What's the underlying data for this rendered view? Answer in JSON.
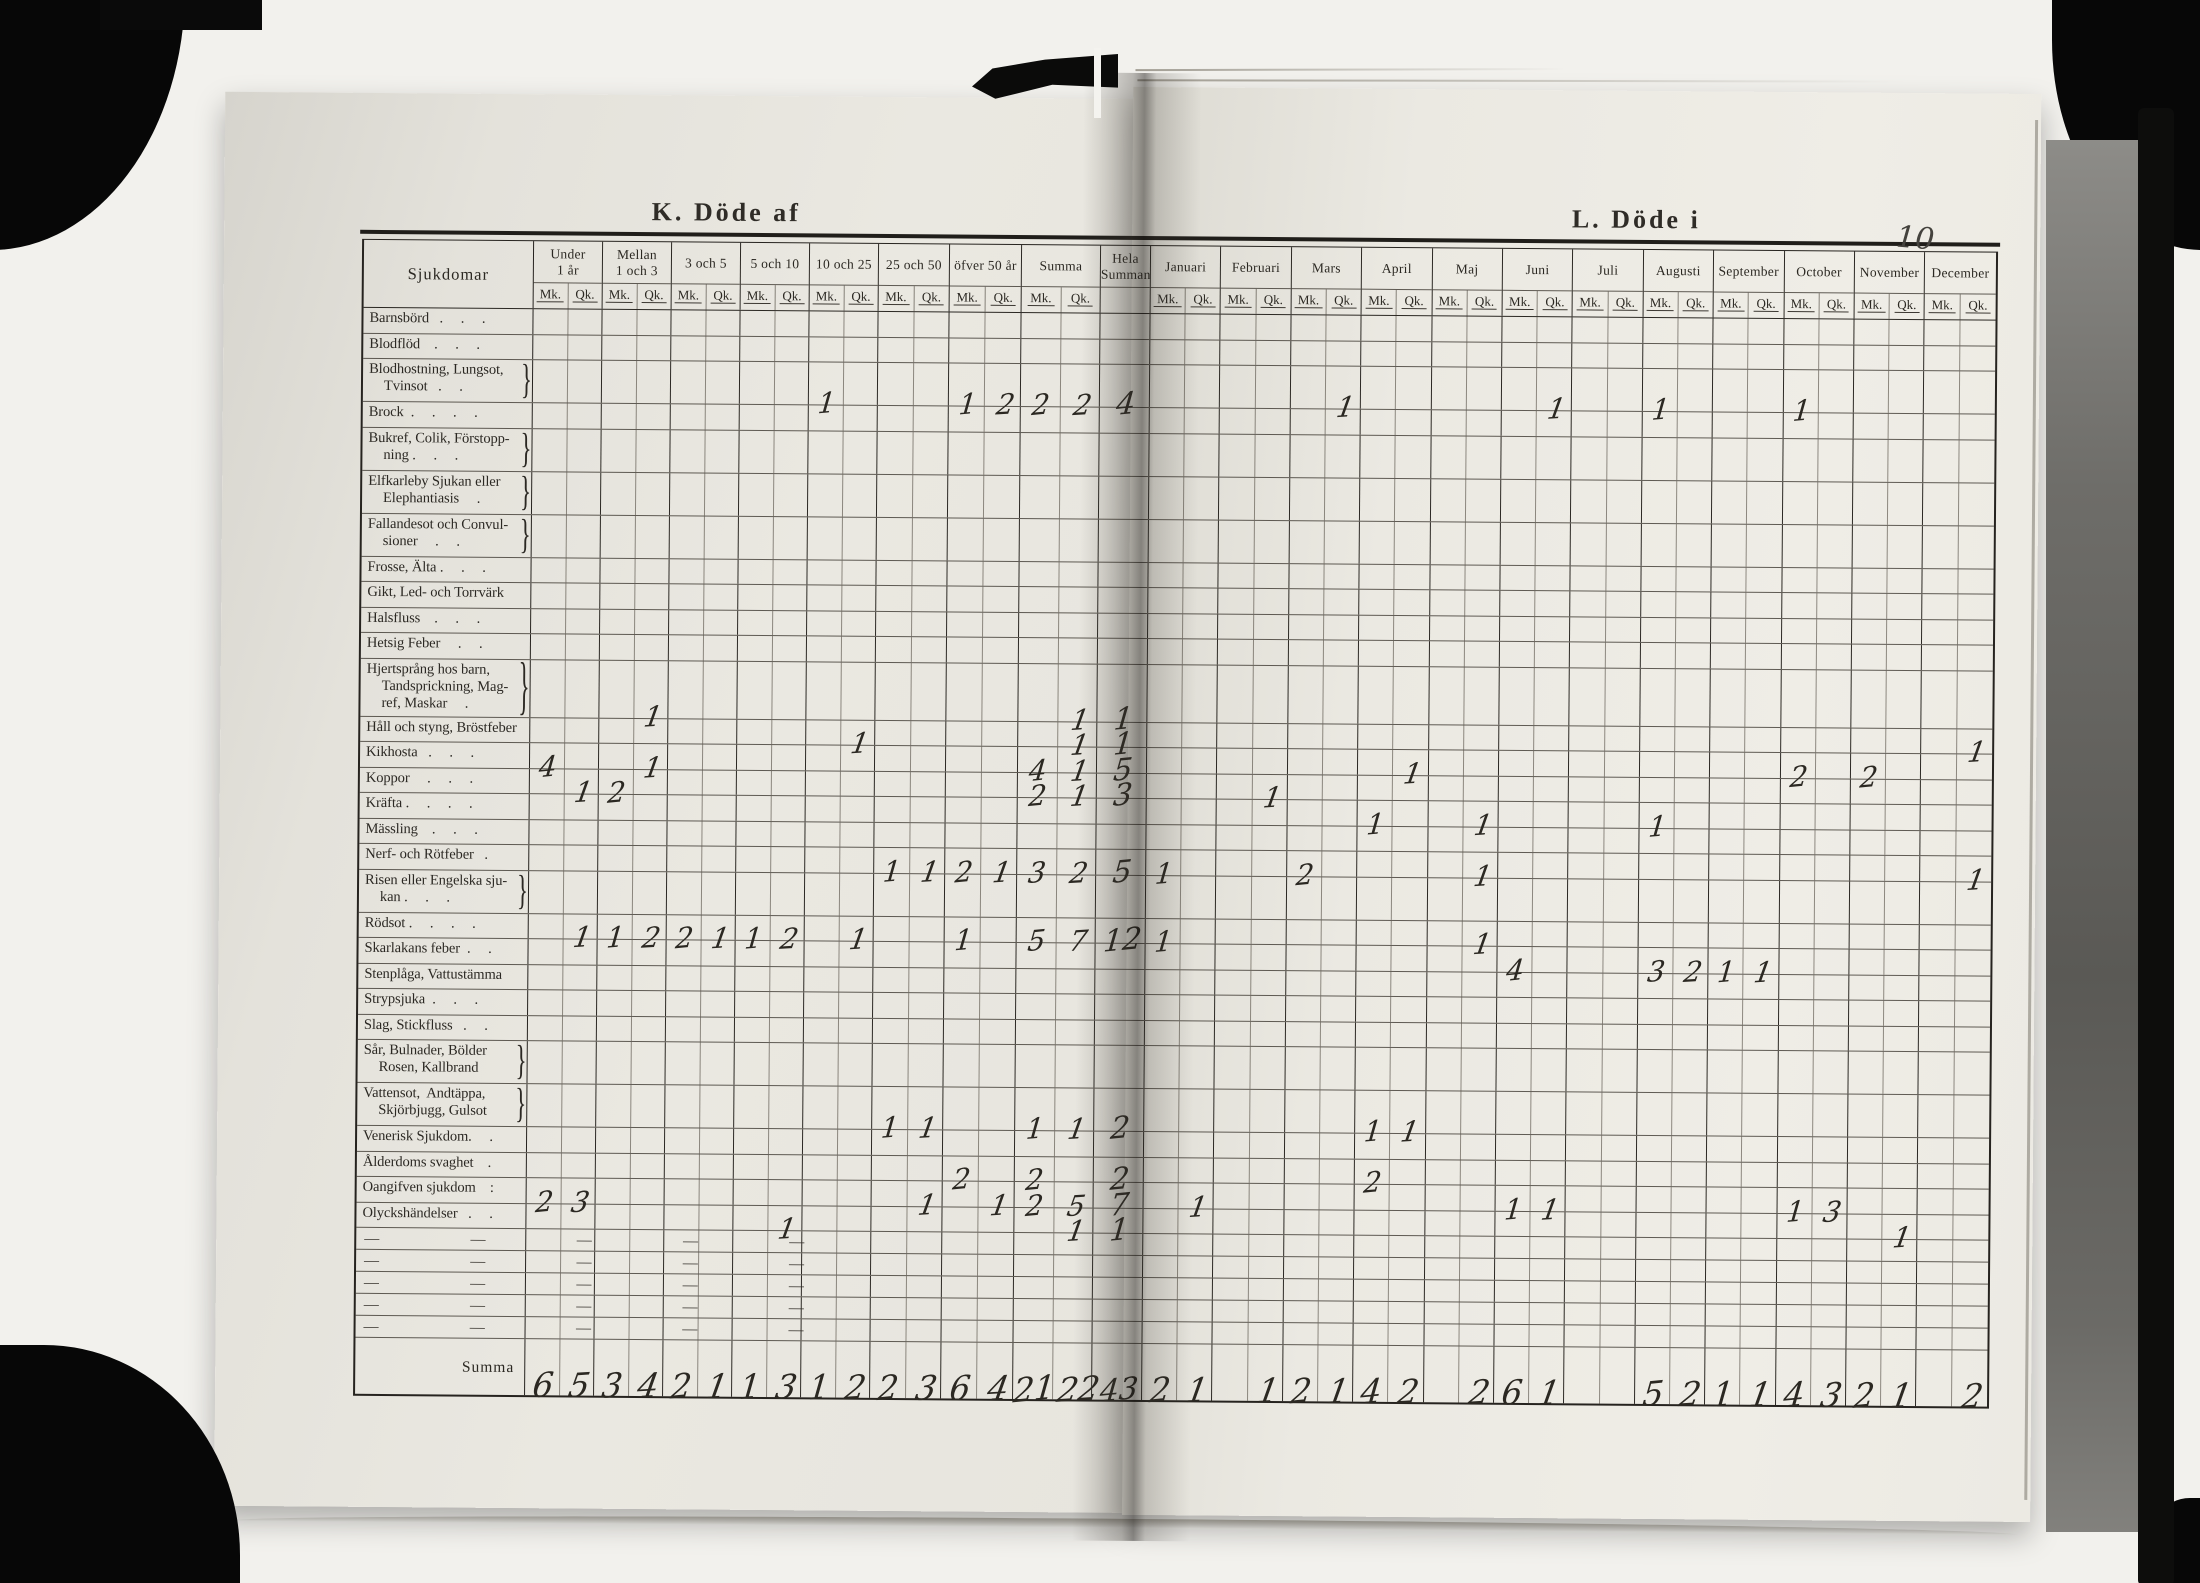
{
  "left_title": "K. Döde af",
  "right_title": "L. Döde i",
  "page_number": "10",
  "table": {
    "diseases_header": "Sjukdomar",
    "subcol_labels": {
      "mk": "Mk.",
      "qk": "Qk."
    },
    "summa_row_label": "Summa",
    "dash_row_label": "—   —   —   —   —",
    "dash_rows": 5,
    "column_groups": [
      {
        "key": "u1",
        "lines": [
          "Under",
          "1 år"
        ]
      },
      {
        "key": "m13",
        "lines": [
          "Mellan",
          "1 och 3"
        ]
      },
      {
        "key": "a35",
        "lines": [
          "3 och 5"
        ]
      },
      {
        "key": "a510",
        "lines": [
          "5 och 10"
        ]
      },
      {
        "key": "a1025",
        "lines": [
          "10 och 25"
        ]
      },
      {
        "key": "a2550",
        "lines": [
          "25 och 50"
        ]
      },
      {
        "key": "o50",
        "lines": [
          "öfver 50 år"
        ]
      },
      {
        "key": "sum",
        "lines": [
          "Summa"
        ]
      },
      {
        "key": "hs",
        "lines": [
          "Hela",
          "Summan"
        ],
        "single": true
      },
      {
        "key": "jan",
        "lines": [
          "Januari"
        ]
      },
      {
        "key": "feb",
        "lines": [
          "Februari"
        ]
      },
      {
        "key": "mar",
        "lines": [
          "Mars"
        ]
      },
      {
        "key": "apr",
        "lines": [
          "April"
        ]
      },
      {
        "key": "maj",
        "lines": [
          "Maj"
        ]
      },
      {
        "key": "jun",
        "lines": [
          "Juni"
        ]
      },
      {
        "key": "jul",
        "lines": [
          "Juli"
        ]
      },
      {
        "key": "aug",
        "lines": [
          "Augusti"
        ]
      },
      {
        "key": "sep",
        "lines": [
          "September"
        ]
      },
      {
        "key": "okt",
        "lines": [
          "October"
        ]
      },
      {
        "key": "nov",
        "lines": [
          "November"
        ]
      },
      {
        "key": "dec",
        "lines": [
          "December"
        ]
      }
    ],
    "rows": [
      {
        "lines": [
          "Barnsbörd   .     .     ."
        ],
        "cells": {}
      },
      {
        "lines": [
          "Blodflöd    .     .     ."
        ],
        "cells": {}
      },
      {
        "lines": [
          "Blodhostning, Lungsot,",
          "Tvinsot   .     ."
        ],
        "brace": true,
        "cells": {
          "a1025_mk": 1,
          "o50_mk": 1,
          "o50_qk": 2,
          "sum_mk": 2,
          "sum_qk": 2,
          "hs": 4,
          "mar_qk": 1,
          "jun_qk": 1,
          "aug_mk": 1,
          "okt_mk": 1
        }
      },
      {
        "lines": [
          "Brock  .     .     .     ."
        ],
        "cells": {}
      },
      {
        "lines": [
          "Bukref, Colik, Förstopp-",
          "ning .     .     ."
        ],
        "brace": true,
        "cells": {}
      },
      {
        "lines": [
          "Elfkarleby Sjukan eller",
          "Elephantiasis     ."
        ],
        "brace": true,
        "cells": {}
      },
      {
        "lines": [
          "Fallandesot och Convul-",
          "sioner     .     ."
        ],
        "brace": true,
        "cells": {}
      },
      {
        "lines": [
          "Frosse, Älta .     .     ."
        ],
        "cells": {}
      },
      {
        "lines": [
          "Gikt, Led- och Torrvärk"
        ],
        "cells": {}
      },
      {
        "lines": [
          "Halsfluss    .     .     ."
        ],
        "cells": {}
      },
      {
        "lines": [
          "Hetsig Feber     .     ."
        ],
        "cells": {}
      },
      {
        "lines": [
          "Hjertsprång hos barn,",
          "Tandsprickning, Mag-",
          "ref, Maskar     ."
        ],
        "brace": true,
        "cells": {
          "m13_qk": 1,
          "sum_qk": 1,
          "hs": 1
        }
      },
      {
        "lines": [
          "Håll och styng, Bröstfeber"
        ],
        "cells": {
          "a1025_qk": 1,
          "sum_qk": 1,
          "hs": 1,
          "dec_qk": 1
        }
      },
      {
        "lines": [
          "Kikhosta   .     .     ."
        ],
        "cells": {
          "u1_mk": 4,
          "m13_qk": 1,
          "sum_mk": 4,
          "sum_qk": 1,
          "hs": 5,
          "apr_qk": 1,
          "okt_mk": 2,
          "nov_mk": 2
        }
      },
      {
        "lines": [
          "Koppor     .     .     ."
        ],
        "cells": {
          "u1_qk": 1,
          "m13_mk": 2,
          "sum_mk": 2,
          "sum_qk": 1,
          "hs": 3,
          "feb_qk": 1
        }
      },
      {
        "lines": [
          "Kräfta .     .     .     ."
        ],
        "cells": {
          "apr_mk": 1,
          "maj_qk": 1,
          "aug_mk": 1
        }
      },
      {
        "lines": [
          "Mässling    .     .     ."
        ],
        "cells": {}
      },
      {
        "lines": [
          "Nerf- och Rötfeber   ."
        ],
        "cells": {
          "a2550_mk": 1,
          "a2550_qk": 1,
          "o50_mk": 2,
          "o50_qk": 1,
          "sum_mk": 3,
          "sum_qk": 2,
          "hs": 5,
          "jan_mk": 1,
          "mar_mk": 2,
          "maj_qk": 1,
          "dec_qk": 1
        }
      },
      {
        "lines": [
          "Risen eller Engelska sju-",
          "kan .     .     ."
        ],
        "brace": true,
        "cells": {}
      },
      {
        "lines": [
          "Rödsot .     .     .     ."
        ],
        "cells": {
          "u1_qk": 1,
          "m13_mk": 1,
          "m13_qk": 2,
          "a35_mk": 2,
          "a35_qk": 1,
          "a510_mk": 1,
          "a510_qk": 2,
          "a1025_qk": 1,
          "o50_mk": 1,
          "sum_mk": 5,
          "sum_qk": 7,
          "hs": 12,
          "jan_mk": 1,
          "maj_qk": 1
        }
      },
      {
        "lines": [
          "Skarlakans feber  .     ."
        ],
        "cells": {
          "jun_mk": 4,
          "aug_mk": 3,
          "aug_qk": 2,
          "sep_mk": 1,
          "sep_qk": 1
        }
      },
      {
        "lines": [
          "Stenplåga, Vattustämma"
        ],
        "cells": {}
      },
      {
        "lines": [
          "Strypsjuka  .     .     ."
        ],
        "cells": {}
      },
      {
        "lines": [
          "Slag, Stickfluss   .     ."
        ],
        "cells": {}
      },
      {
        "lines": [
          "Sår, Bulnader, Bölder",
          "Rosen, Kallbrand"
        ],
        "brace": true,
        "cells": {}
      },
      {
        "lines": [
          "Vattensot,  Andtäppa,",
          "Skjörbjugg, Gulsot"
        ],
        "brace": true,
        "cells": {
          "a2550_mk": 1,
          "a2550_qk": 1,
          "sum_mk": 1,
          "sum_qk": 1,
          "hs": 2,
          "apr_mk": 1,
          "apr_qk": 1
        }
      },
      {
        "lines": [
          "Venerisk Sjukdom.     ."
        ],
        "cells": {}
      },
      {
        "lines": [
          "Ålderdoms svaghet    ."
        ],
        "cells": {
          "o50_mk": 2,
          "sum_mk": 2,
          "hs": 2,
          "apr_mk": 2
        }
      },
      {
        "lines": [
          "Oangifven sjukdom    :"
        ],
        "cells": {
          "u1_mk": 2,
          "u1_qk": 3,
          "a2550_qk": 1,
          "o50_qk": 1,
          "sum_mk": 2,
          "sum_qk": 5,
          "hs": 7,
          "jan_qk": 1,
          "jun_mk": 1,
          "jun_qk": 1,
          "okt_mk": 1,
          "okt_qk": 3
        }
      },
      {
        "lines": [
          "Olyckshändelser   .     ."
        ],
        "cells": {
          "a510_qk": 1,
          "sum_qk": 1,
          "hs": 1,
          "nov_qk": 1
        }
      }
    ],
    "summa_cells": {
      "u1_mk": 6,
      "u1_qk": 5,
      "m13_mk": 3,
      "m13_qk": 4,
      "a35_mk": 2,
      "a35_qk": 1,
      "a510_mk": 1,
      "a510_qk": 3,
      "a1025_mk": 1,
      "a1025_qk": 2,
      "a2550_mk": 2,
      "a2550_qk": 3,
      "o50_mk": 6,
      "o50_qk": 4,
      "sum_mk": 21,
      "sum_qk": 22,
      "hs": 43,
      "jan_mk": 2,
      "jan_qk": 1,
      "feb_qk": 1,
      "mar_mk": 2,
      "mar_qk": 1,
      "apr_mk": 4,
      "apr_qk": 2,
      "maj_qk": 2,
      "jun_mk": 6,
      "jun_qk": 1,
      "aug_mk": 5,
      "aug_qk": 2,
      "sep_mk": 1,
      "sep_qk": 1,
      "okt_mk": 4,
      "okt_qk": 3,
      "nov_mk": 2,
      "nov_qk": 1,
      "dec_qk": 2
    }
  }
}
